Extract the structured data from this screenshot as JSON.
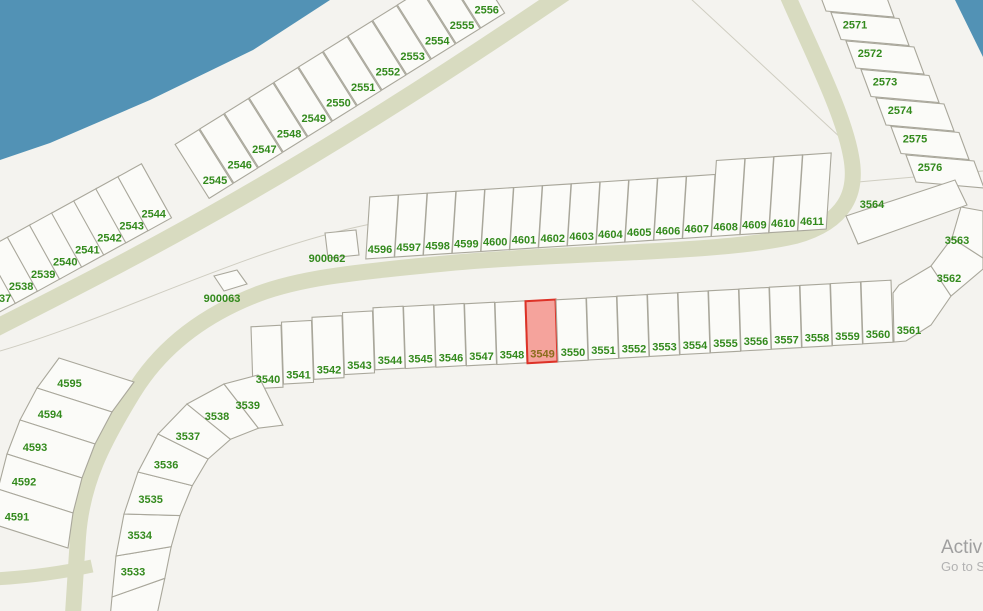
{
  "map": {
    "highlighted_lot": "3549",
    "colors": {
      "water": "#5292b5",
      "road": "#d8dbc0",
      "land": "#f4f3ef",
      "parcel_fill": "#fbfbf8",
      "parcel_stroke": "#a9a79b",
      "lot_label": "#338a1d",
      "highlight_fill": "#f5a39c",
      "highlight_stroke": "#dd3227",
      "highlight_label": "#8a6c1c"
    },
    "parcels": {
      "shore_row_block1": [
        "2537",
        "2538",
        "2539",
        "2540",
        "2541",
        "2542",
        "2543",
        "2544"
      ],
      "shore_row_block2": [
        "2545",
        "2546",
        "2547",
        "2548",
        "2549",
        "2550",
        "2551",
        "2552",
        "2553",
        "2554",
        "2555",
        "2556"
      ],
      "topright_column": [
        "2571",
        "2572",
        "2573",
        "2574",
        "2575",
        "2576"
      ],
      "mid_row": [
        "4596",
        "4597",
        "4598",
        "4599",
        "4600",
        "4601",
        "4602",
        "4603",
        "4604",
        "4605",
        "4606",
        "4607",
        "4608",
        "4609",
        "4610",
        "4611"
      ],
      "main_row": [
        "3540",
        "3541",
        "3542",
        "3543",
        "3544",
        "3545",
        "3546",
        "3547",
        "3548",
        "3549",
        "3550",
        "3551",
        "3552",
        "3553",
        "3554",
        "3555",
        "3556",
        "3557",
        "3558",
        "3559",
        "3560"
      ],
      "arc_block": [
        "3533",
        "3534",
        "3535",
        "3536",
        "3537",
        "3538",
        "3539"
      ],
      "corner_fan": [
        "3561",
        "3562",
        "3563",
        "3564"
      ],
      "left_column": [
        "4591",
        "4592",
        "4593",
        "4594",
        "4595"
      ],
      "squares": [
        "900062",
        "900063"
      ]
    },
    "watermark": {
      "line1": "Activate Windows",
      "line2": "Go to Settings to activate Windows."
    }
  }
}
